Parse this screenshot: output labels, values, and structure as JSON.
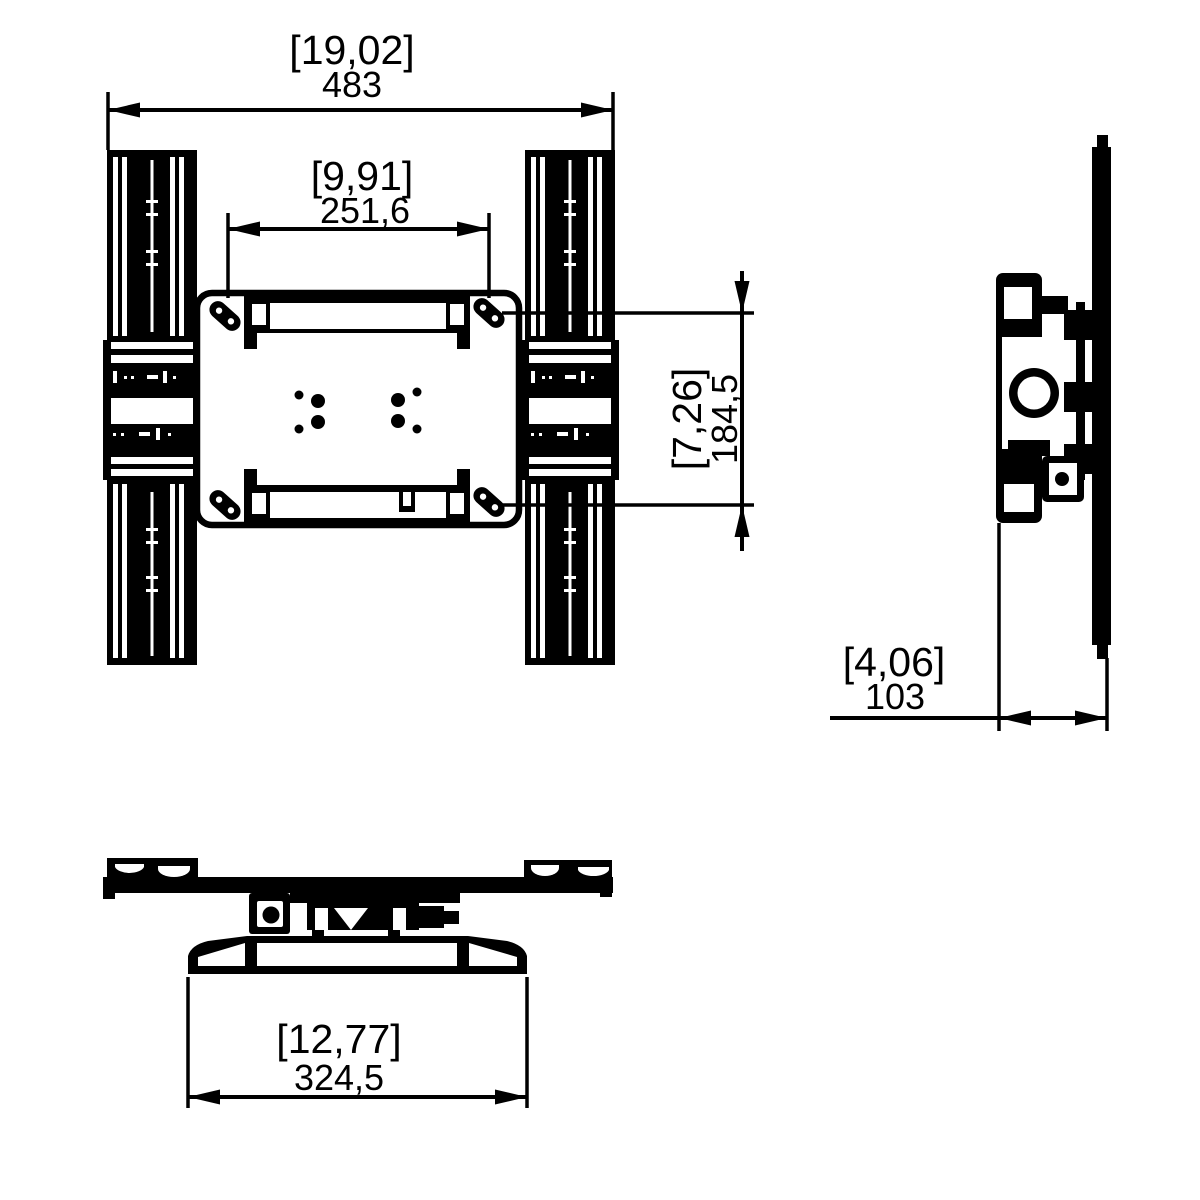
{
  "drawing": {
    "kind": "technical-dimension-drawing",
    "subject": "wall-mount-bracket",
    "colors": {
      "line": "#000000",
      "background": "#ffffff"
    },
    "views": {
      "front": "front view",
      "side": "side view",
      "top": "top view"
    },
    "dimensions": {
      "overall_width": {
        "inches_label": "[19,02]",
        "mm_label": "483"
      },
      "inner_width": {
        "inches_label": "[9,91]",
        "mm_label": "251,6"
      },
      "slot_height": {
        "inches_label": "[7,26]",
        "mm_label": "184,5"
      },
      "depth": {
        "inches_label": "[4,06]",
        "mm_label": "103"
      },
      "wall_plate_width": {
        "inches_label": "[12,77]",
        "mm_label": "324,5"
      }
    }
  }
}
